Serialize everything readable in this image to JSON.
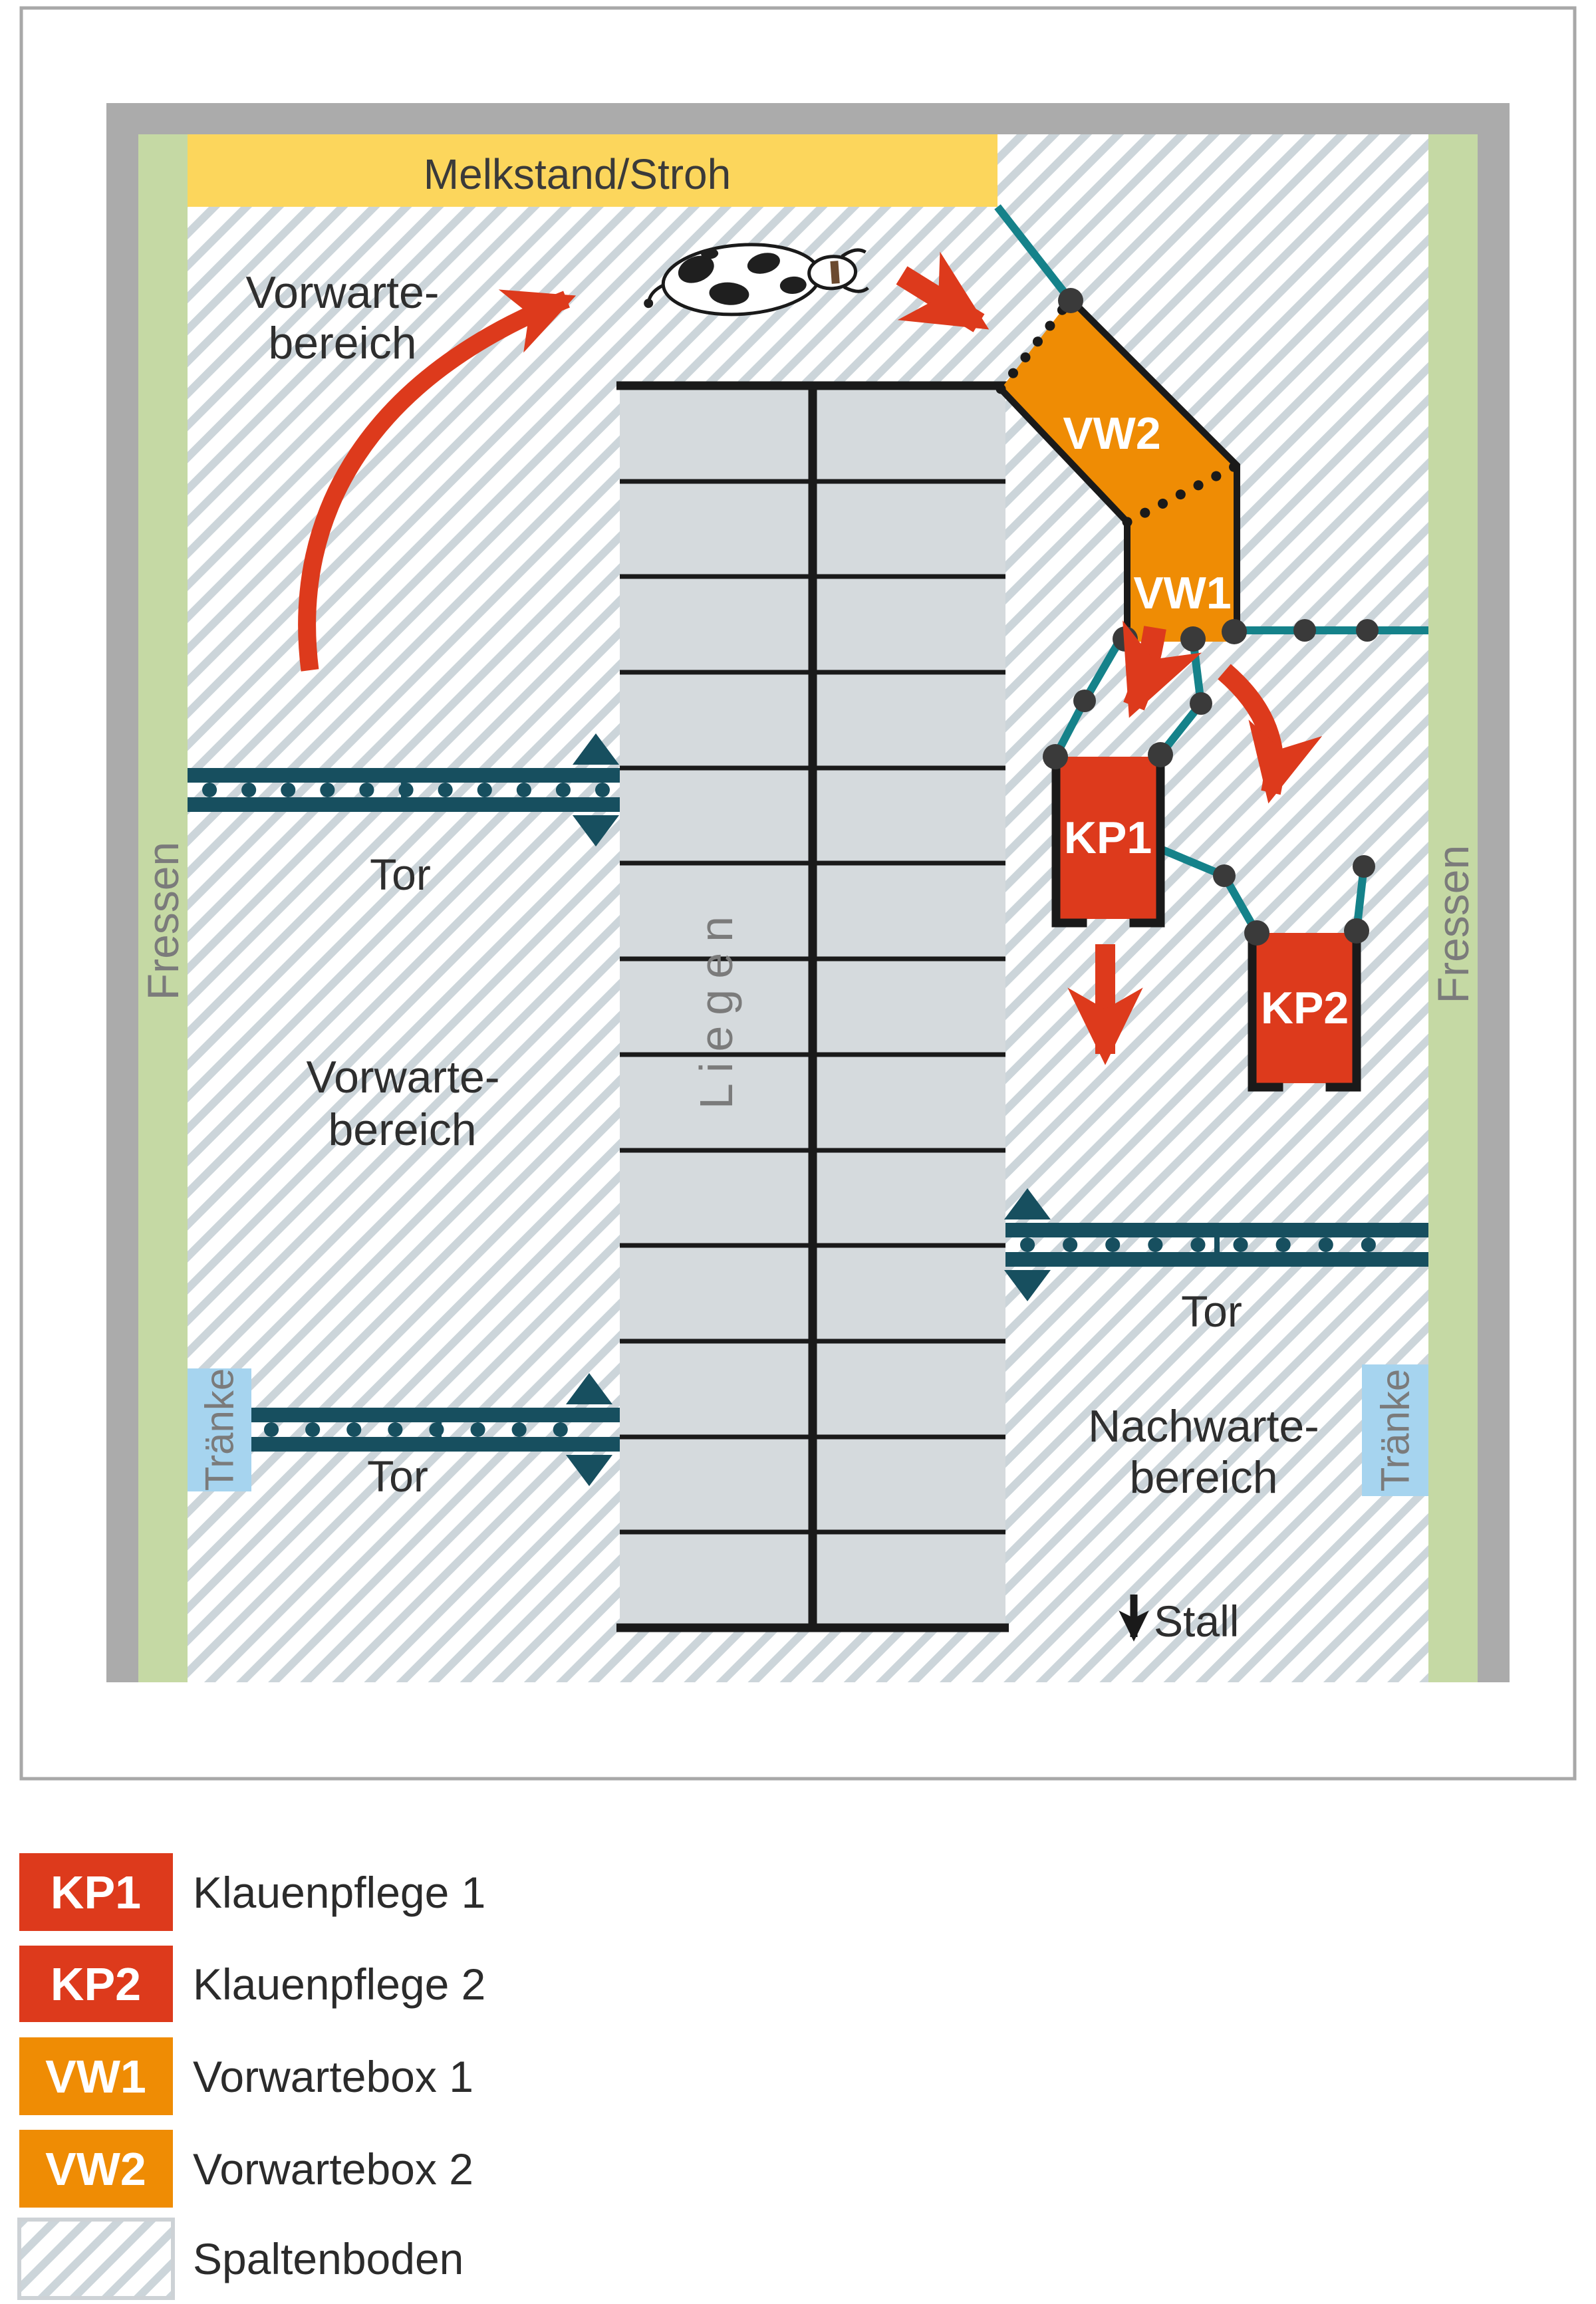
{
  "title": "Stallplan Melkstand mit Klauenpflege",
  "colors": {
    "red": "#dd3a1c",
    "orange": "#ef8c04",
    "yellow": "#fcd65c",
    "green": "#c5d9a4",
    "wall_gray": "#ababab",
    "hatch_stripe": "#ccd5da",
    "cell_gray": "#d5dadd",
    "gate_dark": "#174f5f",
    "teal_line": "#15828a",
    "water_blue": "#a6d4ef",
    "joint_dot": "#3a3a3a",
    "ink": "#1a1a1a",
    "muted_label": "#7b7b7b",
    "frame": "#a8a8a8"
  },
  "areas": {
    "melkstand": "Melkstand/Stroh",
    "vorwarte_top": [
      "Vorwarte-",
      "bereich"
    ],
    "vorwarte_left": [
      "Vorwarte-",
      "bereich"
    ],
    "nachwarte": [
      "Nachwarte-",
      "bereich"
    ],
    "liegen": "Liegen",
    "fressen_left": "Fressen",
    "fressen_right": "Fressen",
    "traenke_left": "Tränke",
    "traenke_right": "Tränke",
    "stall": "Stall"
  },
  "gates": {
    "upper_left": "Tor",
    "lower_left": "Tor",
    "right": "Tor"
  },
  "boxes": {
    "vw1": "VW1",
    "vw2": "VW2",
    "kp1": "KP1",
    "kp2": "KP2"
  },
  "legend": {
    "items": [
      {
        "key": "KP1",
        "label": "Klauenpflege 1",
        "color": "#dd3a1c"
      },
      {
        "key": "KP2",
        "label": "Klauenpflege 2",
        "color": "#dd3a1c"
      },
      {
        "key": "VW1",
        "label": "Vorwartebox 1",
        "color": "#ef8c04"
      },
      {
        "key": "VW2",
        "label": "Vorwartebox 2",
        "color": "#ef8c04"
      },
      {
        "key": "",
        "label": "Spaltenboden",
        "swatch": "hatch"
      }
    ]
  }
}
